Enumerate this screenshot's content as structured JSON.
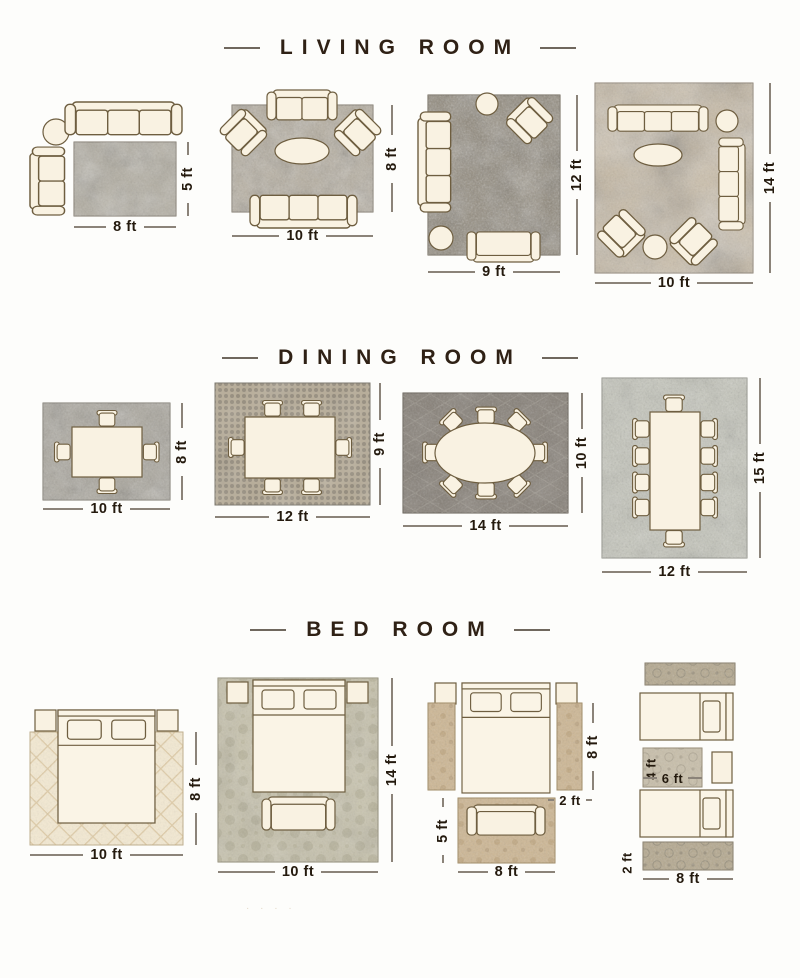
{
  "page": {
    "watermark": "· · · ·"
  },
  "colors": {
    "background": "#fdfdfb",
    "title_text": "#2f2115",
    "dimension_text": "#241a0e",
    "dimension_line": "#8b8379",
    "furniture_fill": "#f9f2e2",
    "furniture_outline": "#6e5e40"
  },
  "sections": {
    "living": {
      "title": "LIVING ROOM",
      "layouts": [
        {
          "width": "8 ft",
          "height": "5 ft"
        },
        {
          "width": "10 ft",
          "height": "8 ft"
        },
        {
          "width": "9 ft",
          "height": "12 ft"
        },
        {
          "width": "10 ft",
          "height": "14 ft"
        }
      ]
    },
    "dining": {
      "title": "DINING ROOM",
      "layouts": [
        {
          "width": "10 ft",
          "height": "8 ft"
        },
        {
          "width": "12 ft",
          "height": "9 ft"
        },
        {
          "width": "14 ft",
          "height": "10 ft"
        },
        {
          "width": "12 ft",
          "height": "15 ft"
        }
      ]
    },
    "bed": {
      "title": "BED ROOM",
      "layouts": [
        {
          "width": "10 ft",
          "height": "8 ft"
        },
        {
          "width": "10 ft",
          "height": "14 ft"
        },
        {
          "runner_height": "8 ft",
          "runner_width": "2 ft",
          "foot_rug_height": "5 ft",
          "foot_rug_width": "8 ft"
        },
        {
          "middle_rug_height": "4 ft",
          "middle_rug_width": "6 ft",
          "runner_height": "2 ft",
          "runner_width": "8 ft"
        }
      ]
    }
  }
}
